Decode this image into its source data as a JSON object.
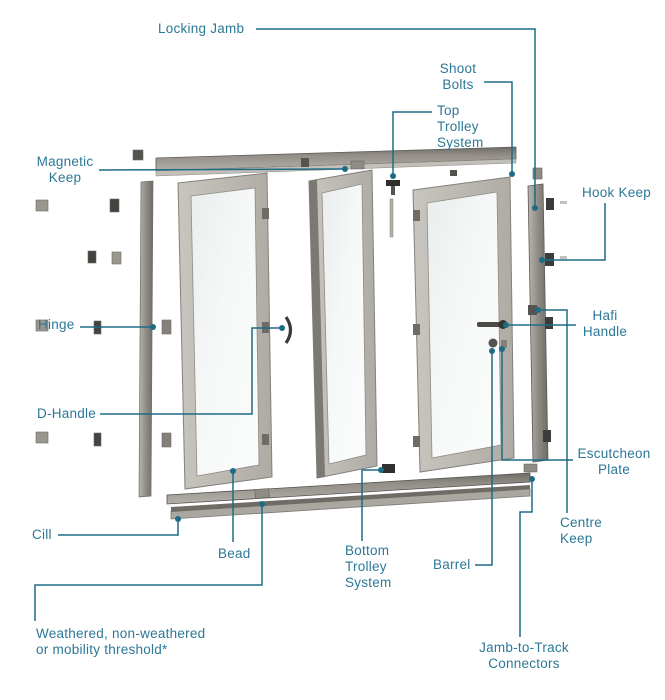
{
  "diagram_type": "bi-fold door exploded parts diagram",
  "accent": {
    "label_color": "#2b7897",
    "leader_line_color": "#1e6b85",
    "frame_color": "#b5b2ac",
    "track_color": "#8d8a83",
    "hardware_color": "#434340"
  },
  "labels": {
    "locking_jamb": "Locking Jamb",
    "shoot_bolts": "Shoot\nBolts",
    "top_trolley": "Top\nTrolley\nSystem",
    "magnetic_keep": "Magnetic\nKeep",
    "hook_keep": "Hook Keep",
    "hinge": "Hinge",
    "hafi_handle": "Hafi\nHandle",
    "d_handle": "D-Handle",
    "escutcheon_plate": "Escutcheon\nPlate",
    "centre_keep": "Centre\nKeep",
    "cill": "Cill",
    "bead": "Bead",
    "bottom_trolley": "Bottom\nTrolley\nSystem",
    "barrel": "Barrel",
    "weathered_threshold": "Weathered, non-weathered\nor mobility threshold*",
    "jamb_to_track": "Jamb-to-Track\nConnectors"
  }
}
